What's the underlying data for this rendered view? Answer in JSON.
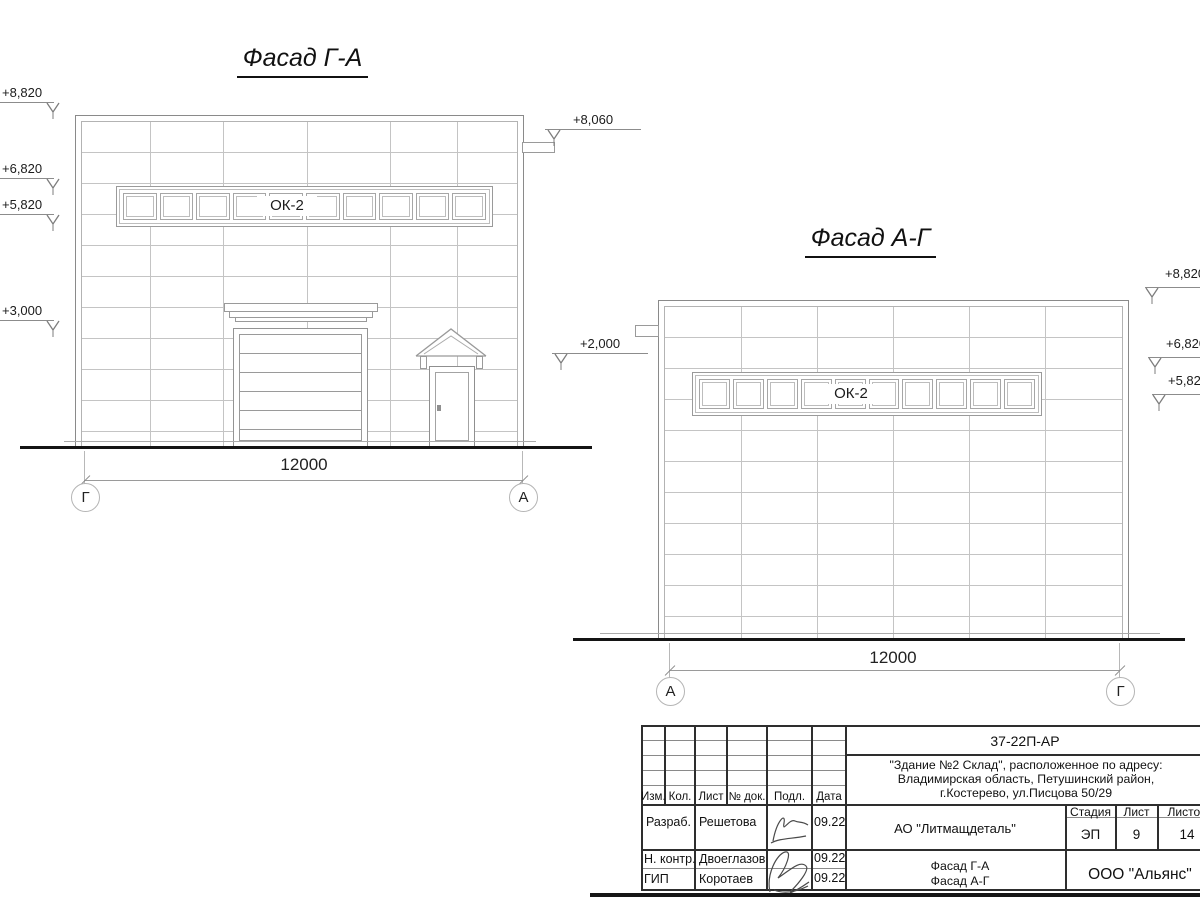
{
  "facade_left": {
    "title": "Фасад Г-А",
    "window_label": "ОК-2",
    "dim_label": "12000",
    "axis_left": "Г",
    "axis_right": "А",
    "elev_left": [
      "+8,820",
      "+6,820",
      "+5,820",
      "+3,000"
    ],
    "elev_right": [
      "+8,060",
      "+2,000"
    ]
  },
  "facade_right": {
    "title": "Фасад А-Г",
    "window_label": "ОК-2",
    "dim_label": "12000",
    "axis_left": "А",
    "axis_right": "Г",
    "elev_right": [
      "+8,820",
      "+6,820",
      "+5,820"
    ]
  },
  "titleblock": {
    "doc_number": "37-22П-АР",
    "address_line1": "\"Здание №2 Склад\", расположенное по адресу:",
    "address_line2": "Владимирская область, Петушинский район,",
    "address_line3": "г.Костерево, ул.Писцова 50/29",
    "col_izm": "Изм.",
    "col_kol": "Кол.",
    "col_list": "Лист",
    "col_doc": "№ док.",
    "col_podp": "Подл.",
    "col_data": "Дата",
    "row1_role": "Разраб.",
    "row1_name": "Решетова",
    "row1_date": "09.22",
    "row2_role": "Н. контр.",
    "row2_name": "Двоеглазов",
    "row2_date": "09.22",
    "row3_role": "ГИП",
    "row3_name": "Коротаев",
    "row3_date": "09.22",
    "client": "АО \"Литмащдеталь\"",
    "stage_header": "Стадия",
    "sheet_header": "Лист",
    "sheets_header": "Листов",
    "stage": "ЭП",
    "sheet": "9",
    "sheets_total": "14",
    "subject_line1": "Фасад Г-А",
    "subject_line2": "Фасад А-Г",
    "company": "ООО \"Альянс\""
  },
  "colors": {
    "line_light": "#c4c4c4",
    "line_mid": "#9a9a9a",
    "line_dark": "#2e2e2e",
    "text": "#1c1c1c",
    "ground": "#141414"
  }
}
